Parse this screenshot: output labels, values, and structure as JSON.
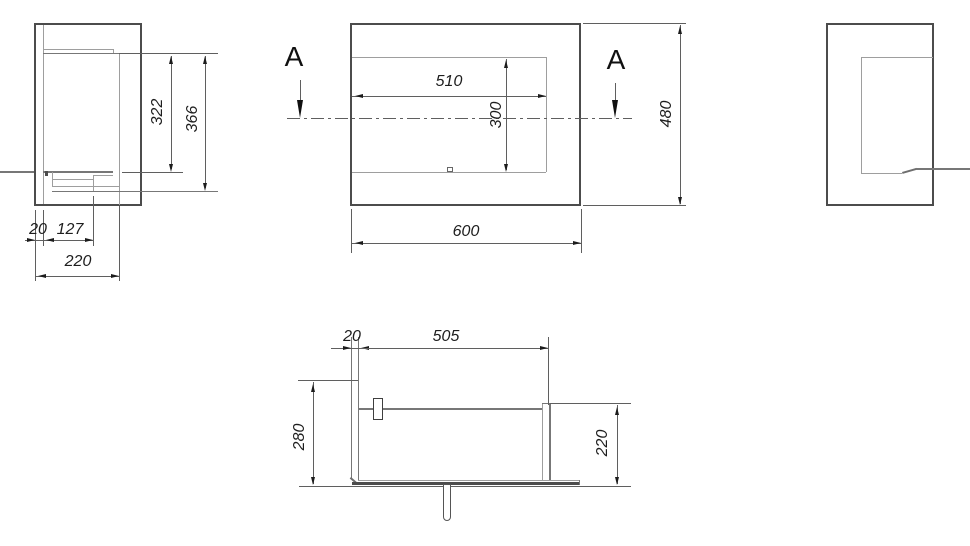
{
  "drawing": {
    "kind": "technical-dimension-drawing",
    "ink_colors": {
      "outline": "#4c4c4c",
      "thin_line": "#9e9e9e",
      "dimension": "#5f5f5f",
      "text": "#1e1e1e"
    },
    "views": {
      "side_left": {
        "name": "left side view",
        "dims": {
          "d322": "322",
          "d366": "366",
          "d20": "20",
          "d127": "127",
          "d220": "220"
        }
      },
      "front": {
        "name": "front view",
        "section_label": "A",
        "dims": {
          "d510": "510",
          "d300": "300",
          "d600": "600",
          "d480": "480"
        }
      },
      "side_right": {
        "name": "right side view"
      },
      "section": {
        "name": "section view",
        "dims": {
          "d20": "20",
          "d505": "505",
          "d280": "280",
          "d220": "220"
        }
      }
    }
  }
}
